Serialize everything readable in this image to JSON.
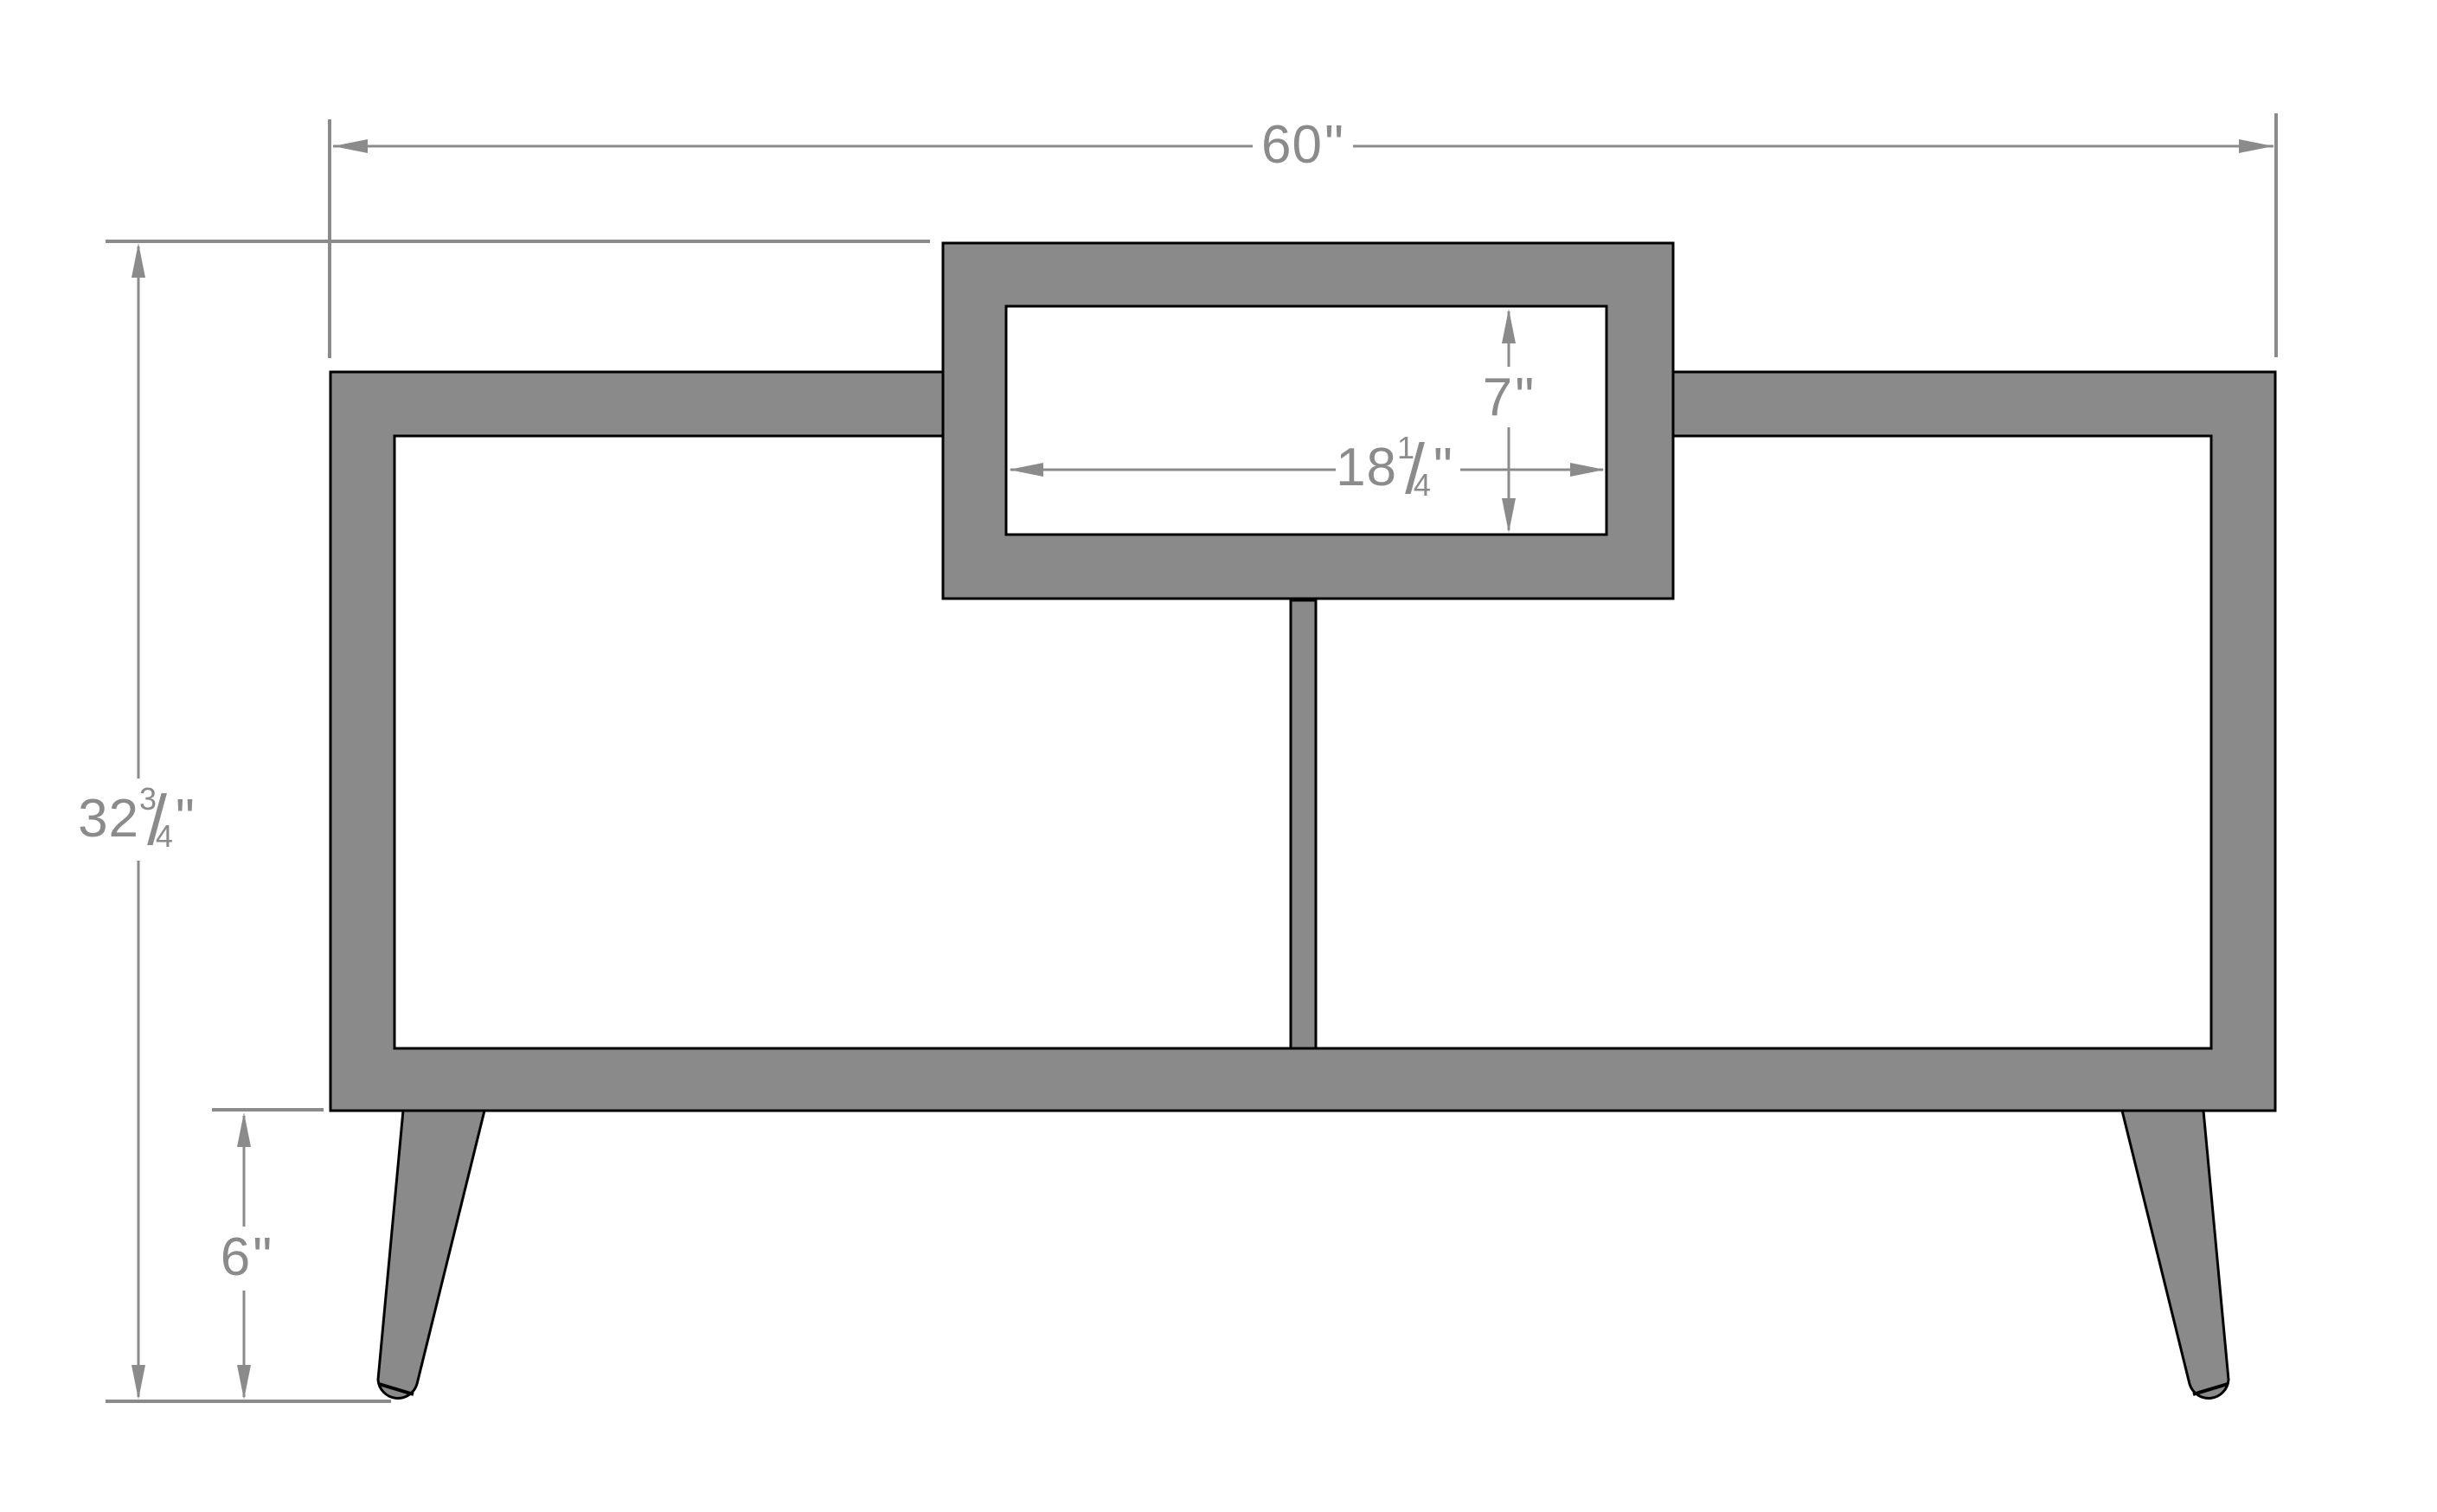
{
  "diagram": {
    "dimensions": {
      "overall_width": {
        "whole": "60",
        "unit": "\""
      },
      "overall_height": {
        "whole": "32",
        "num": "3",
        "den": "4",
        "slash": "/",
        "unit": "\""
      },
      "top_opening_height": {
        "whole": "7",
        "unit": "\""
      },
      "top_opening_width": {
        "whole": "18",
        "num": "1",
        "den": "4",
        "slash": "/",
        "unit": "\""
      },
      "leg_height": {
        "whole": "6",
        "unit": "\""
      }
    }
  },
  "colors": {
    "body": "#8a8a8a",
    "outline": "#000000",
    "annotation": "#8b8b8b",
    "background": "#ffffff"
  }
}
